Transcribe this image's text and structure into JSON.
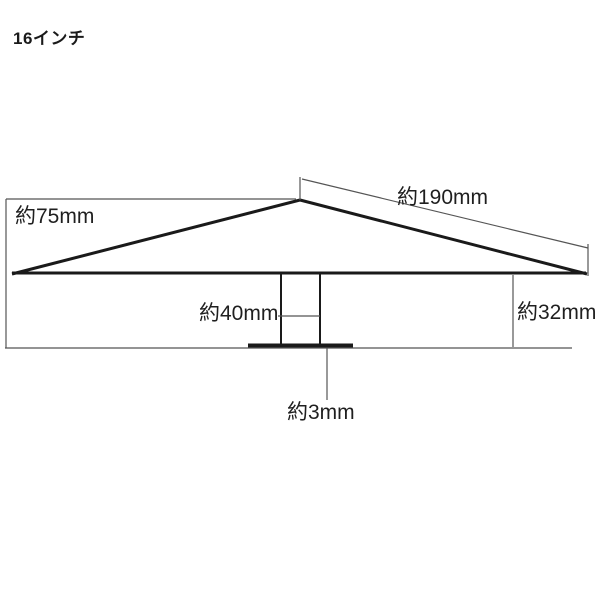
{
  "title": "16インチ",
  "labels": {
    "total_height": "約75mm",
    "slope_length": "約190mm",
    "edge_height": "約32mm",
    "pole_width": "約40mm",
    "base_thickness": "約3mm"
  },
  "colors": {
    "line": "#1a1a1a",
    "background": "#ffffff"
  }
}
